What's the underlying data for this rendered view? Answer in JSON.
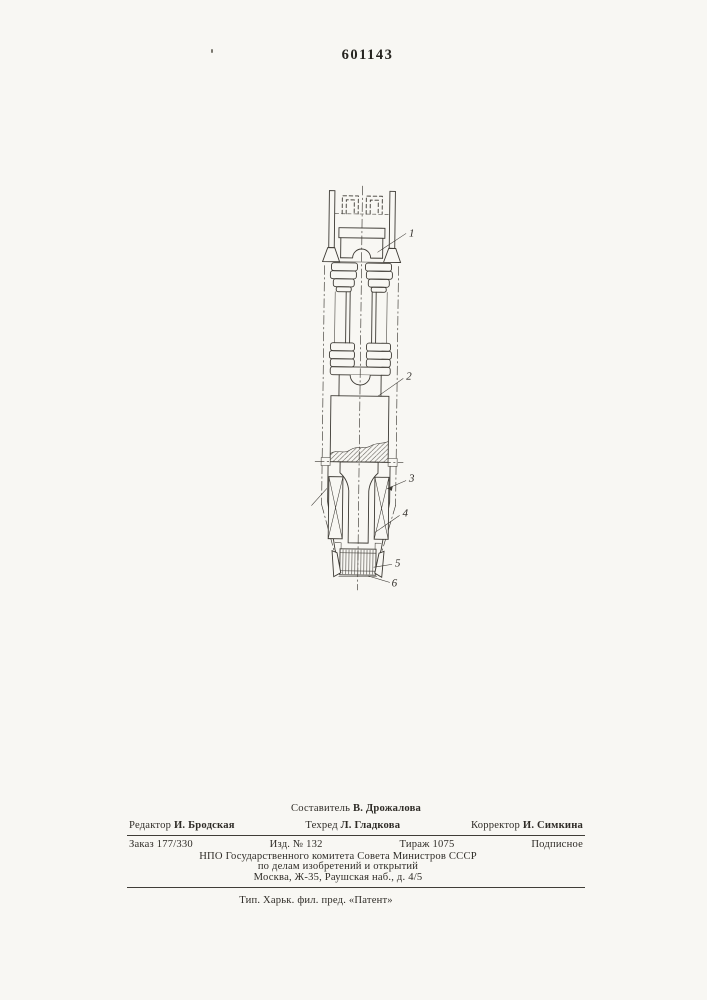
{
  "page": {
    "patent_number": "601143"
  },
  "colors": {
    "paper": "#f8f7f3",
    "ink": "#3c3933"
  },
  "figure": {
    "callouts": [
      "1",
      "2",
      "3",
      "4",
      "5",
      "6"
    ]
  },
  "imprint": {
    "compiler_role": "Составитель",
    "compiler_name": "В. Дрожалова",
    "editor_role": "Редактор",
    "editor_name": "И. Бродская",
    "techred_role": "Техред",
    "techred_name": "Л. Гладкова",
    "corrector_role": "Корректор",
    "corrector_name": "И. Симкина",
    "order": "Заказ 177/330",
    "edition": "Изд. № 132",
    "tirage": "Тираж 1075",
    "subscription": "Подписное",
    "org_line1": "НПО Государственного комитета Совета Министров СССР",
    "org_line2": "по делам изобретений и открытий",
    "org_line3": "Москва, Ж-35, Раушская наб., д. 4/5",
    "printer": "Тип. Харьк. фил. пред. «Патент»"
  }
}
